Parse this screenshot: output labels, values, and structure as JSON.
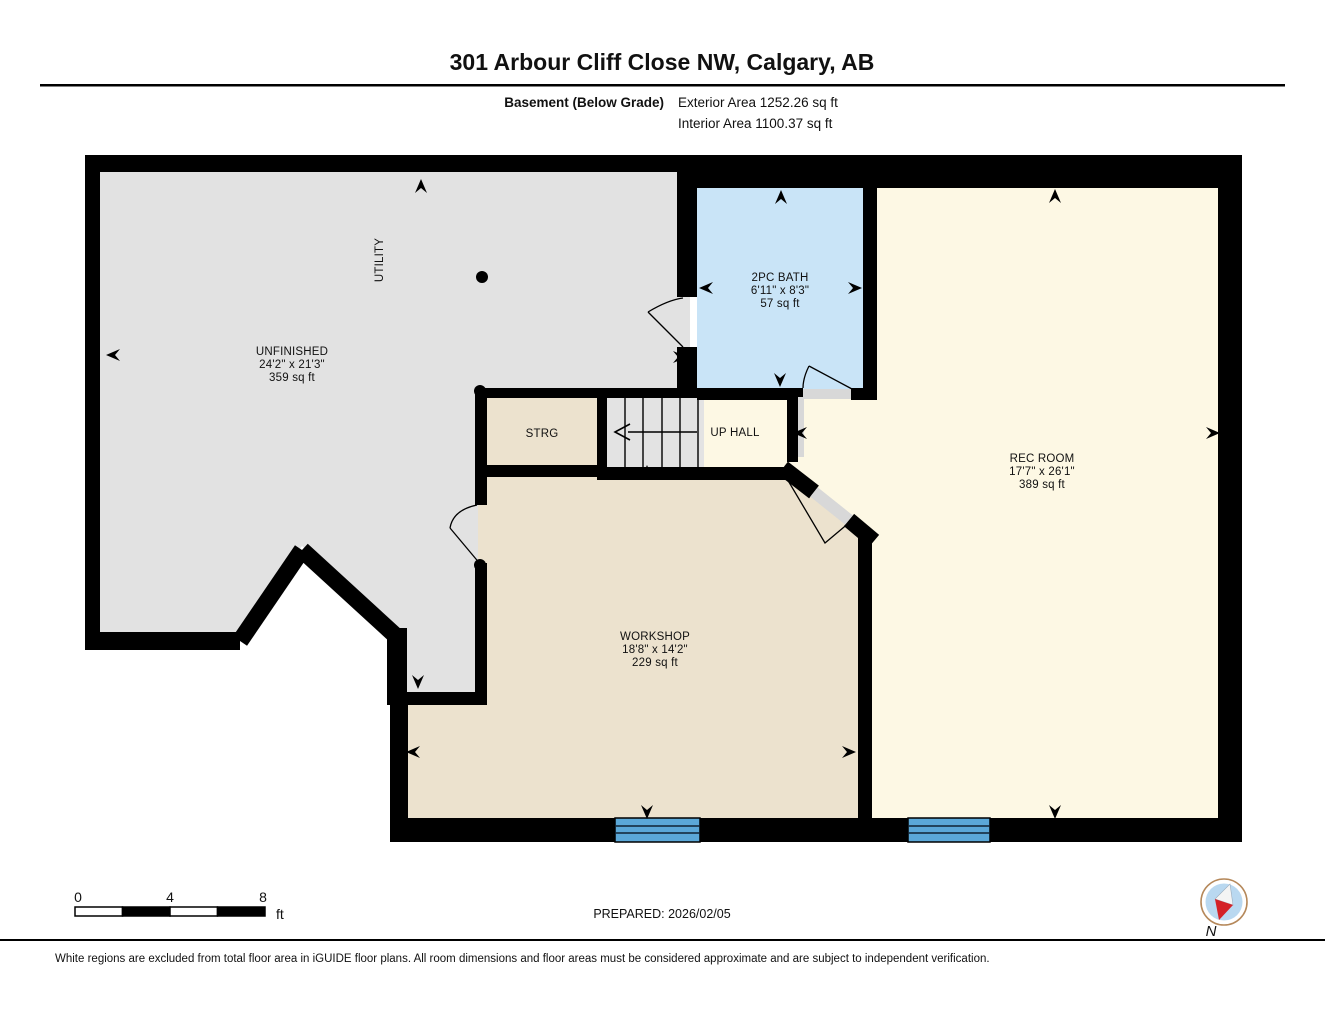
{
  "header": {
    "title": "301 Arbour Cliff Close NW, Calgary, AB",
    "floor_label": "Basement (Below Grade)",
    "exterior_area": "Exterior Area 1252.26 sq ft",
    "interior_area": "Interior Area 1100.37 sq ft"
  },
  "rooms": {
    "unfinished": {
      "name": "UNFINISHED",
      "dimensions": "24'2\" x 21'3\"",
      "area": "359 sq ft"
    },
    "utility": {
      "name": "UTILITY"
    },
    "bath": {
      "name": "2PC BATH",
      "dimensions": "6'11\" x 8'3\"",
      "area": "57 sq ft"
    },
    "rec_room": {
      "name": "REC ROOM",
      "dimensions": "17'7\" x 26'1\"",
      "area": "389 sq ft"
    },
    "strg": {
      "name": "STRG"
    },
    "up_hall": {
      "name": "UP HALL"
    },
    "workshop": {
      "name": "WORKSHOP",
      "dimensions": "18'8\" x 14'2\"",
      "area": "229 sq ft"
    }
  },
  "scale_bar": {
    "tick_0": "0",
    "tick_4": "4",
    "tick_8": "8",
    "unit": "ft"
  },
  "prepared": "PREPARED: 2026/02/05",
  "compass": {
    "label": "N"
  },
  "footer": {
    "disclaimer": "White regions are excluded from total floor area in iGUIDE floor plans. All room dimensions and floor areas must be considered approximate and are subject to independent verification."
  },
  "colors": {
    "wall": "#000000",
    "unfinished_fill": "#e2e2e2",
    "bath_fill": "#c9e4f7",
    "cream_fill": "#fdf8e4",
    "beige_fill": "#ece2ce",
    "window_fill": "#5ba8d8",
    "threshold_fill": "#d8d8d8",
    "compass_ring": "#b5885a",
    "compass_disc": "#b9d8f0",
    "compass_needle_red": "#d42127"
  }
}
